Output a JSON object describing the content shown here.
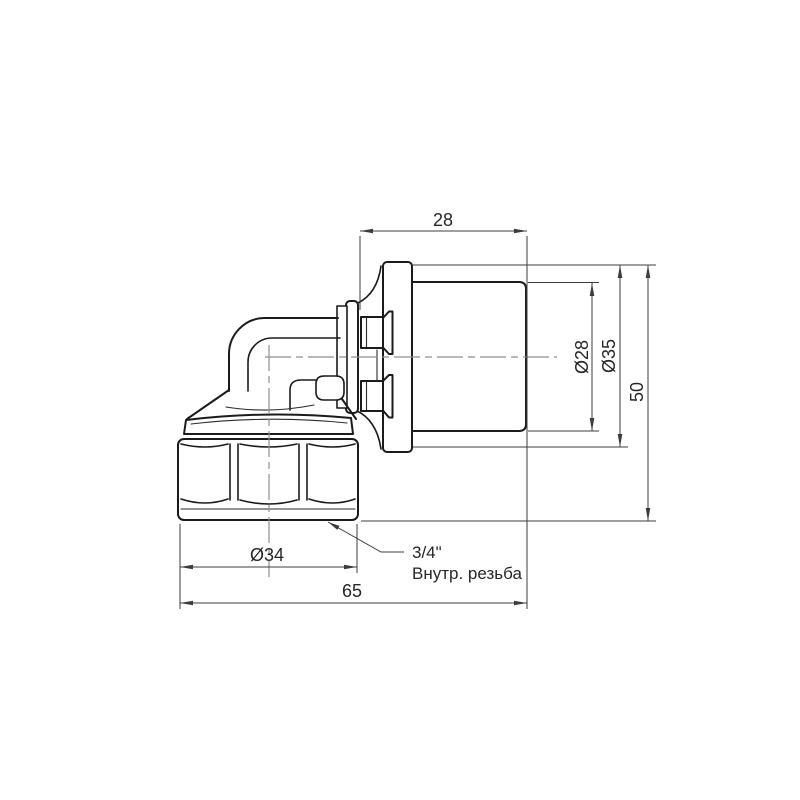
{
  "drawing": {
    "title": "Press elbow fitting with female thread — dimensioned drawing",
    "background": "#ffffff",
    "colors": {
      "outline": "#1b1b1b",
      "dimension": "#3c3c3c",
      "centerline": "#8f8f8f",
      "text": "#262626"
    },
    "dimensions": {
      "top_width": "28",
      "pipe_od": "Ø28",
      "sleeve_od": "Ø35",
      "height": "50",
      "nut_od": "Ø34",
      "overall_length": "65"
    },
    "callout": {
      "size": "3/4\"",
      "label": "Внутр. резьба"
    }
  }
}
